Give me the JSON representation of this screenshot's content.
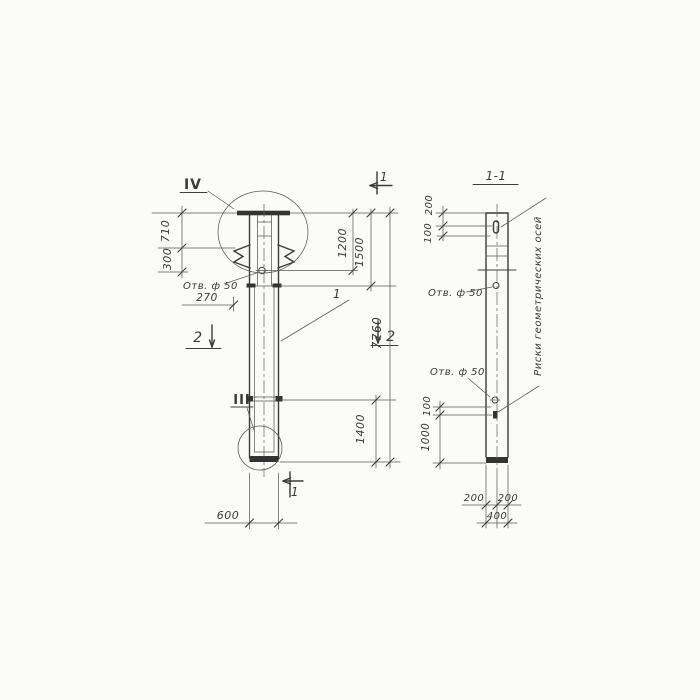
{
  "page": {
    "background": "#fbfbf9",
    "ink": "#3a3a3a"
  },
  "main_view": {
    "detail_marker_top": "IV",
    "detail_marker_bottom": "III",
    "section_cut_top": "1",
    "section_cut_bottom": "1",
    "section_cut_left": "2",
    "section_cut_right": "2",
    "position_label": "1",
    "hole_note": "Отв. ф 50",
    "dims": {
      "head_to_plate": "710",
      "plate_to_bracket": "300",
      "hole_offset": "270",
      "top_to_hole": "1200",
      "top_segment": "1500",
      "overall_length": "7760",
      "bottom_segment": "1400",
      "column_width": "600"
    }
  },
  "section_view": {
    "title": "1-1",
    "hole_note_upper": "Отв. ф 50",
    "hole_note_lower": "Отв. ф 50",
    "axes_note": "Риски геометрических осей",
    "dims": {
      "top_to_mark": "200",
      "mark_height": "100",
      "hole_to_mark": "100",
      "mark_to_bottom": "1000",
      "left_half_width": "200",
      "right_half_width": "200",
      "overall_width": "400"
    }
  }
}
